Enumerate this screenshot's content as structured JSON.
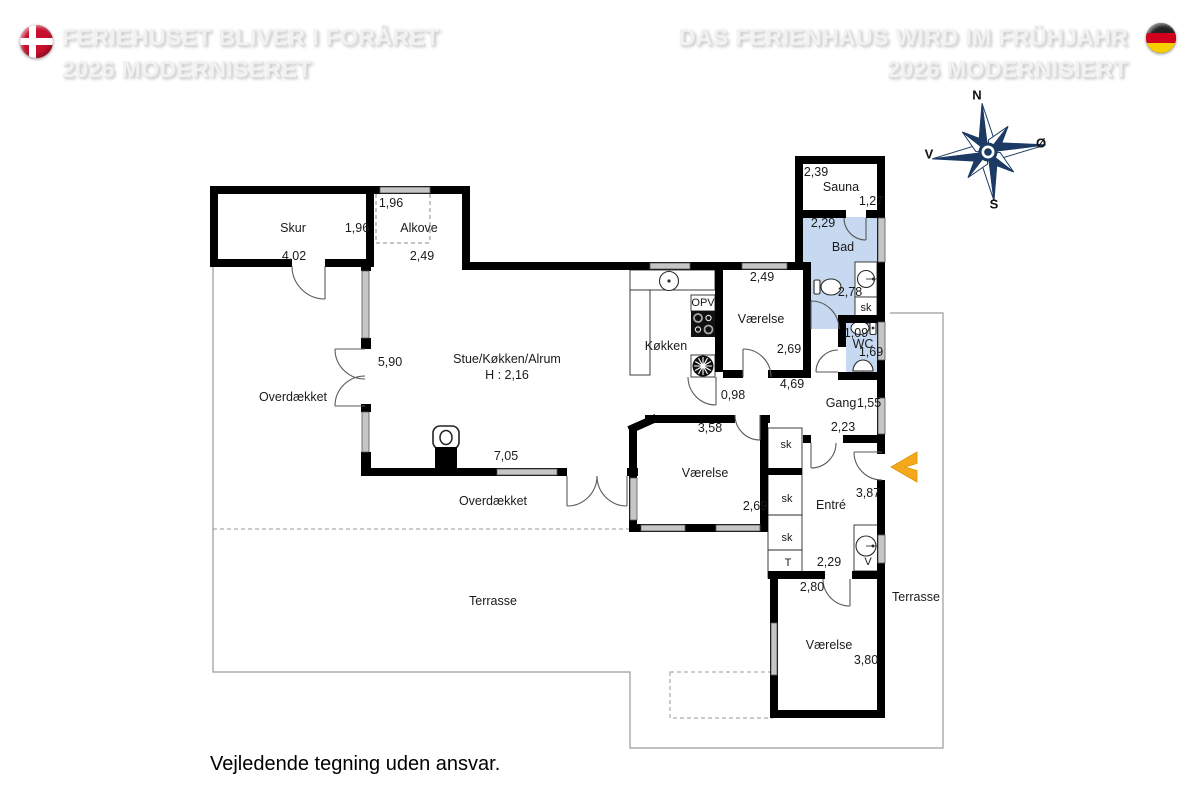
{
  "header": {
    "danish": {
      "line1": "FERIEHUSET BLIVER I FORÅRET",
      "line2": "2026 MODERNISERET"
    },
    "german": {
      "line1": "DAS FERIENHAUS WIRD IM FRÜHJAHR",
      "line2": "2026 MODERNISIERT"
    }
  },
  "compass": {
    "north": "N",
    "south": "S",
    "east": "Ø",
    "west": "V"
  },
  "floorplan": {
    "rooms": [
      {
        "name": "Skur",
        "x": 293,
        "y": 228
      },
      {
        "name": "Alkove",
        "x": 419,
        "y": 228
      },
      {
        "name": "Stue/Køkken/Alrum",
        "x": 507,
        "y": 359
      },
      {
        "name": "Køkken",
        "x": 666,
        "y": 346
      },
      {
        "name": "Værelse",
        "x": 761,
        "y": 319
      },
      {
        "name": "Sauna",
        "x": 841,
        "y": 187
      },
      {
        "name": "Bad",
        "x": 843,
        "y": 247
      },
      {
        "name": "WC",
        "x": 863,
        "y": 344
      },
      {
        "name": "Gang",
        "x": 841,
        "y": 403
      },
      {
        "name": "Entré",
        "x": 831,
        "y": 505
      },
      {
        "name": "Værelse",
        "x": 705,
        "y": 473
      },
      {
        "name": "Værelse",
        "x": 829,
        "y": 645
      },
      {
        "name": "Overdækket",
        "x": 293,
        "y": 397
      },
      {
        "name": "Overdækket",
        "x": 493,
        "y": 501
      },
      {
        "name": "Terrasse",
        "x": 493,
        "y": 601
      },
      {
        "name": "Terrasse",
        "x": 916,
        "y": 597
      }
    ],
    "ceiling_height": {
      "text": "H : 2,16",
      "x": 507,
      "y": 375
    },
    "dimensions": [
      {
        "value": "1,96",
        "x": 357,
        "y": 228
      },
      {
        "value": "4,02",
        "x": 294,
        "y": 256
      },
      {
        "value": "1,96",
        "x": 391,
        "y": 203
      },
      {
        "value": "2,49",
        "x": 422,
        "y": 256
      },
      {
        "value": "5,90",
        "x": 390,
        "y": 362
      },
      {
        "value": "7,05",
        "x": 506,
        "y": 456
      },
      {
        "value": "2,49",
        "x": 762,
        "y": 277
      },
      {
        "value": "2,69",
        "x": 789,
        "y": 349
      },
      {
        "value": "0,98",
        "x": 733,
        "y": 395
      },
      {
        "value": "4,69",
        "x": 792,
        "y": 384
      },
      {
        "value": "3,58",
        "x": 710,
        "y": 428
      },
      {
        "value": "2,69",
        "x": 755,
        "y": 506
      },
      {
        "value": "2,23",
        "x": 843,
        "y": 427
      },
      {
        "value": "3,87",
        "x": 868,
        "y": 493
      },
      {
        "value": "2,29",
        "x": 829,
        "y": 562
      },
      {
        "value": "2,80",
        "x": 812,
        "y": 587
      },
      {
        "value": "3,80",
        "x": 866,
        "y": 660
      },
      {
        "value": "2,39",
        "x": 816,
        "y": 172
      },
      {
        "value": "1,27",
        "x": 871,
        "y": 201
      },
      {
        "value": "2,29",
        "x": 823,
        "y": 223
      },
      {
        "value": "2,78",
        "x": 850,
        "y": 292
      },
      {
        "value": "1,09",
        "x": 856,
        "y": 333
      },
      {
        "value": "1,69",
        "x": 871,
        "y": 352
      },
      {
        "value": "1,55",
        "x": 869,
        "y": 403
      }
    ],
    "fixtures": [
      {
        "label": "OPV",
        "x": 703,
        "y": 303
      },
      {
        "label": "sk",
        "x": 866,
        "y": 308
      },
      {
        "label": "sk",
        "x": 786,
        "y": 445
      },
      {
        "label": "sk",
        "x": 787,
        "y": 499
      },
      {
        "label": "sk",
        "x": 787,
        "y": 538
      },
      {
        "label": "T",
        "x": 788,
        "y": 563
      },
      {
        "label": "V",
        "x": 868,
        "y": 562
      }
    ],
    "icons": [
      "danish-flag-icon",
      "german-flag-icon",
      "compass-rose-icon",
      "toilet-icon",
      "sink-icon",
      "stove-icon",
      "extractor-fan-icon",
      "fireplace-icon",
      "washing-machine-icon",
      "entrance-arrow-icon",
      "radiator-icon"
    ]
  },
  "footer": {
    "disclaimer": "Vejledende tegning uden ansvar."
  },
  "colors": {
    "wet_room": "#C6D9F0",
    "entrance_arrow": "#F5A81C",
    "compass": "#1C3A63"
  }
}
